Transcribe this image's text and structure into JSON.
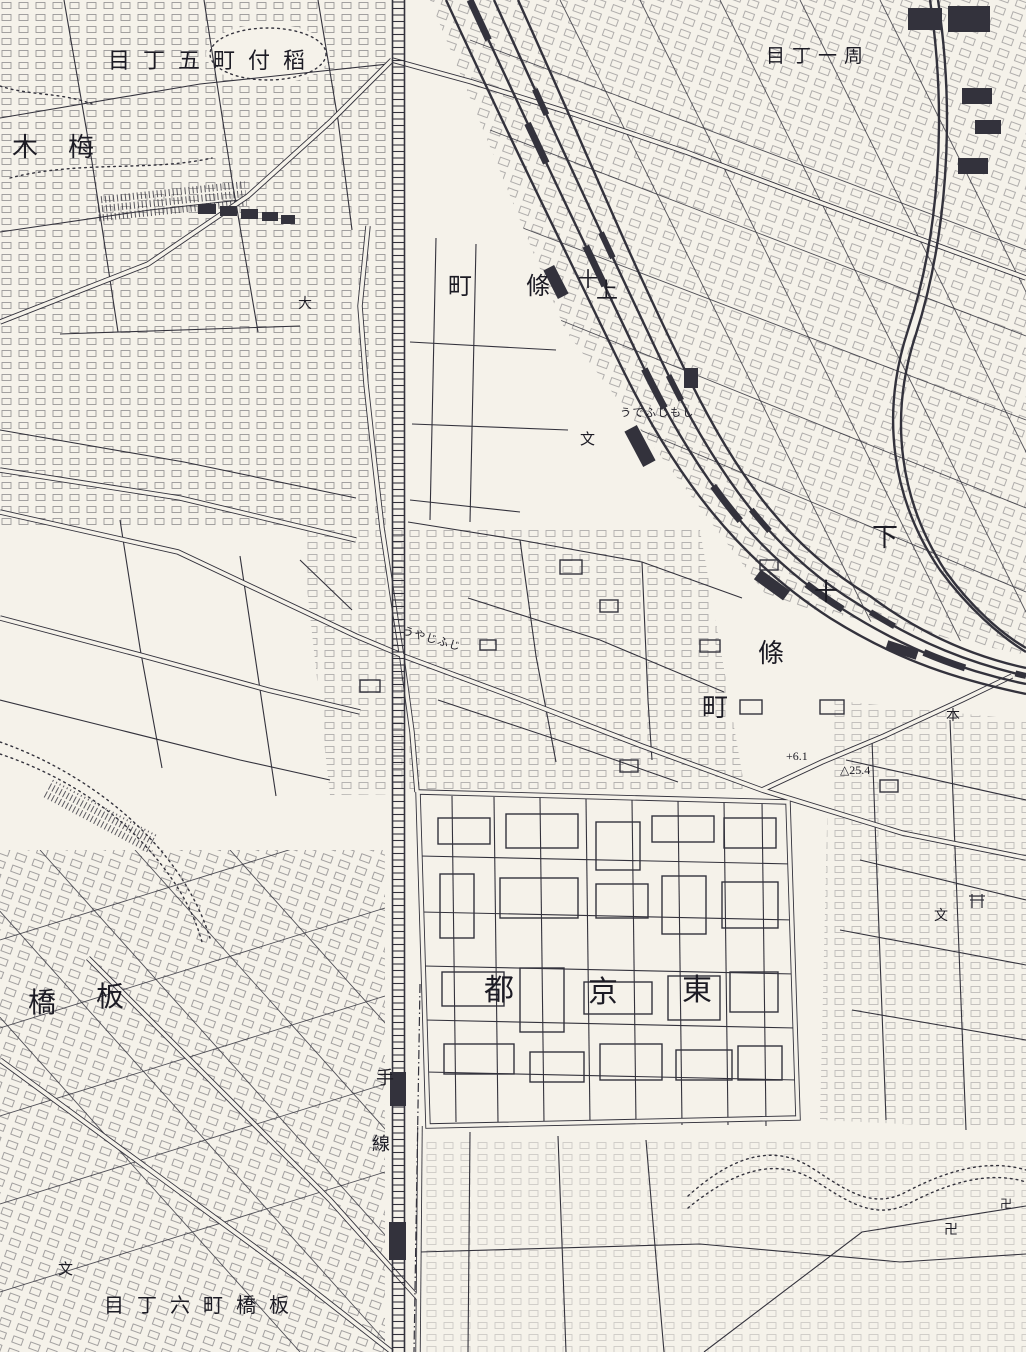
{
  "colors": {
    "paper": "#f5f2ea",
    "ink": "#33323c"
  },
  "labels": [
    {
      "id": "town-inatsuke-5chome",
      "text": "目丁五町付稻"
    },
    {
      "id": "town-1chome",
      "text": "目丁一周"
    },
    {
      "id": "town-umeki",
      "text": "木梅"
    },
    {
      "id": "kamijujo-machi",
      "text": "町"
    },
    {
      "id": "kamijujo-jo",
      "text": "條"
    },
    {
      "id": "kamijujo-ju",
      "text": "十"
    },
    {
      "id": "kamijujo-kami",
      "text": "上"
    },
    {
      "id": "shimojujo-shimo",
      "text": "下"
    },
    {
      "id": "shimojujo-ju",
      "text": "十"
    },
    {
      "id": "shimojujo-jo",
      "text": "條"
    },
    {
      "id": "shimojujo-machi",
      "text": "町"
    },
    {
      "id": "station-kana-shimojujo",
      "text": "うでふじもし"
    },
    {
      "id": "station-kana-jujo",
      "text": "うやじふじ"
    },
    {
      "id": "tokyo-to",
      "text": "都"
    },
    {
      "id": "tokyo-kyo",
      "text": "京"
    },
    {
      "id": "tokyo-higashi",
      "text": "東"
    },
    {
      "id": "itabashi-hashi",
      "text": "橋"
    },
    {
      "id": "itabashi-ita",
      "text": "板"
    },
    {
      "id": "town-itabashi-6chome",
      "text": "目丁六町橋板"
    },
    {
      "id": "railway-te",
      "text": "手"
    },
    {
      "id": "railway-sen",
      "text": "線"
    },
    {
      "id": "elevation-point",
      "text": "+6.1"
    },
    {
      "id": "benchmark-point",
      "text": "△25.4"
    },
    {
      "id": "school-symbol-1",
      "text": "文"
    },
    {
      "id": "school-symbol-2",
      "text": "文"
    },
    {
      "id": "school-symbol-3",
      "text": "文"
    },
    {
      "id": "dai-symbol",
      "text": "大"
    },
    {
      "id": "hon-symbol",
      "text": "本"
    },
    {
      "id": "temple-symbol-1",
      "text": "卍"
    },
    {
      "id": "temple-symbol-2",
      "text": "卍"
    }
  ]
}
